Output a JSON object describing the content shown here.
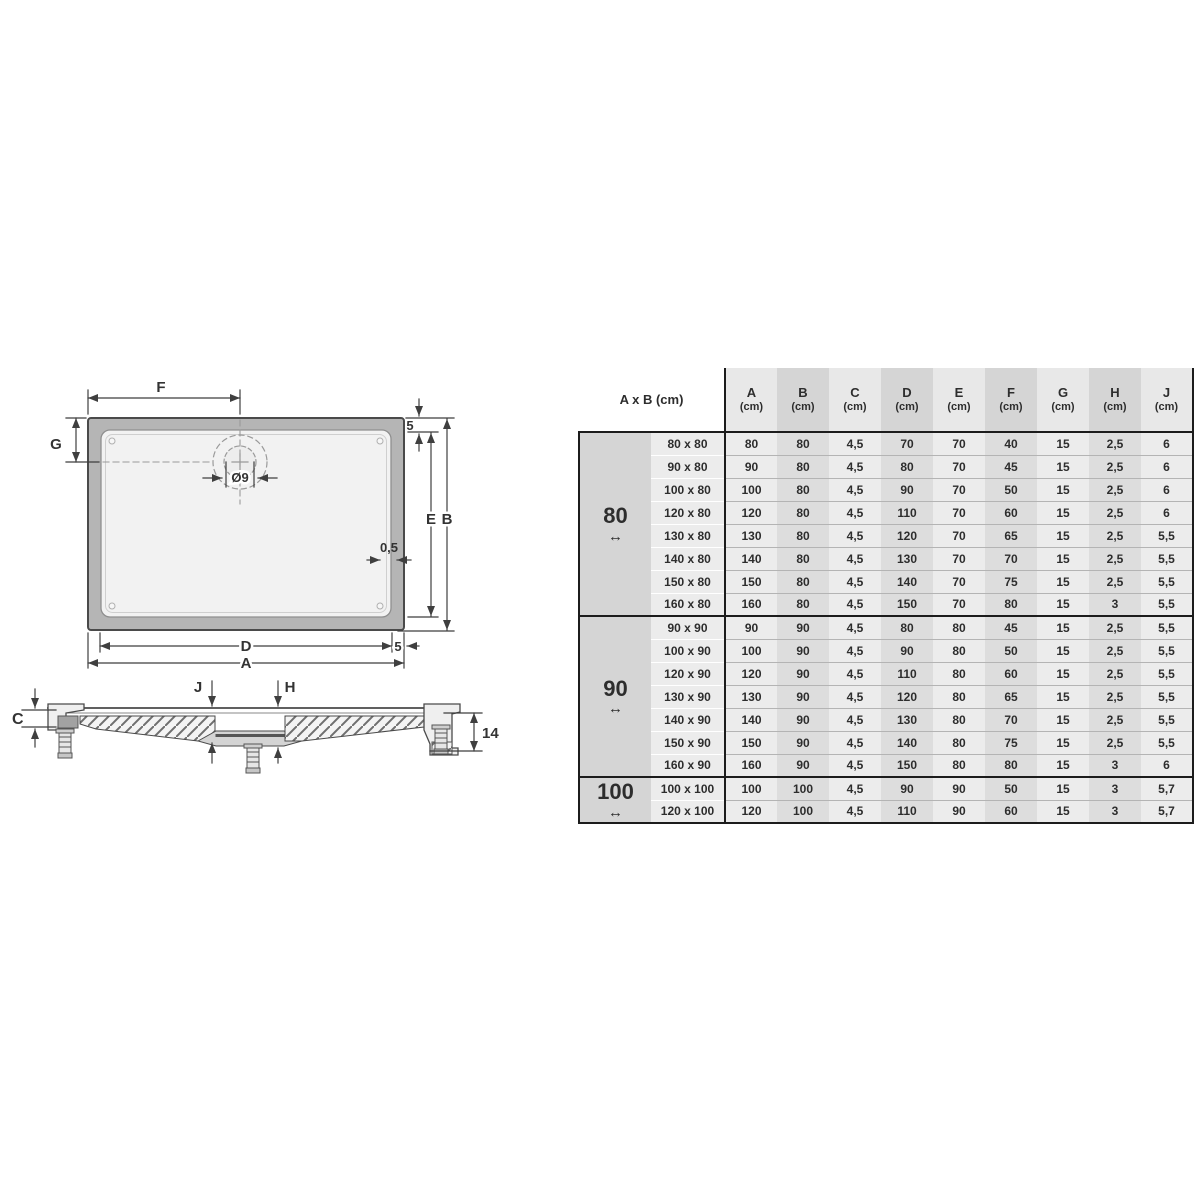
{
  "drawing": {
    "top_view": {
      "f_label": "F",
      "g_label": "G",
      "drain_label": "Ø9",
      "top_gap_label": "5",
      "e_label": "E",
      "b_label": "B",
      "half_label": "0,5",
      "d_label": "D",
      "bottom_gap_label": "5",
      "a_label": "A"
    },
    "side_view": {
      "c_label": "C",
      "j_label": "J",
      "h_label": "H",
      "height_label": "14"
    }
  },
  "table": {
    "corner_header": "A x B (cm)",
    "unit": "(cm)",
    "columns": [
      "A",
      "B",
      "C",
      "D",
      "E",
      "F",
      "G",
      "H",
      "J"
    ],
    "groups": [
      {
        "label": "80",
        "arrow": "↔",
        "rows": [
          {
            "size": "80 x 80",
            "values": [
              "80",
              "80",
              "4,5",
              "70",
              "70",
              "40",
              "15",
              "2,5",
              "6"
            ]
          },
          {
            "size": "90 x 80",
            "values": [
              "90",
              "80",
              "4,5",
              "80",
              "70",
              "45",
              "15",
              "2,5",
              "6"
            ]
          },
          {
            "size": "100 x 80",
            "values": [
              "100",
              "80",
              "4,5",
              "90",
              "70",
              "50",
              "15",
              "2,5",
              "6"
            ]
          },
          {
            "size": "120 x 80",
            "values": [
              "120",
              "80",
              "4,5",
              "110",
              "70",
              "60",
              "15",
              "2,5",
              "6"
            ]
          },
          {
            "size": "130 x 80",
            "values": [
              "130",
              "80",
              "4,5",
              "120",
              "70",
              "65",
              "15",
              "2,5",
              "5,5"
            ]
          },
          {
            "size": "140 x 80",
            "values": [
              "140",
              "80",
              "4,5",
              "130",
              "70",
              "70",
              "15",
              "2,5",
              "5,5"
            ]
          },
          {
            "size": "150 x 80",
            "values": [
              "150",
              "80",
              "4,5",
              "140",
              "70",
              "75",
              "15",
              "2,5",
              "5,5"
            ]
          },
          {
            "size": "160 x 80",
            "values": [
              "160",
              "80",
              "4,5",
              "150",
              "70",
              "80",
              "15",
              "3",
              "5,5"
            ]
          }
        ]
      },
      {
        "label": "90",
        "arrow": "↔",
        "rows": [
          {
            "size": "90 x 90",
            "values": [
              "90",
              "90",
              "4,5",
              "80",
              "80",
              "45",
              "15",
              "2,5",
              "5,5"
            ]
          },
          {
            "size": "100 x 90",
            "values": [
              "100",
              "90",
              "4,5",
              "90",
              "80",
              "50",
              "15",
              "2,5",
              "5,5"
            ]
          },
          {
            "size": "120 x 90",
            "values": [
              "120",
              "90",
              "4,5",
              "110",
              "80",
              "60",
              "15",
              "2,5",
              "5,5"
            ]
          },
          {
            "size": "130 x 90",
            "values": [
              "130",
              "90",
              "4,5",
              "120",
              "80",
              "65",
              "15",
              "2,5",
              "5,5"
            ]
          },
          {
            "size": "140 x 90",
            "values": [
              "140",
              "90",
              "4,5",
              "130",
              "80",
              "70",
              "15",
              "2,5",
              "5,5"
            ]
          },
          {
            "size": "150 x 90",
            "values": [
              "150",
              "90",
              "4,5",
              "140",
              "80",
              "75",
              "15",
              "2,5",
              "5,5"
            ]
          },
          {
            "size": "160 x 90",
            "values": [
              "160",
              "90",
              "4,5",
              "150",
              "80",
              "80",
              "15",
              "3",
              "6"
            ]
          }
        ]
      },
      {
        "label": "100",
        "arrow": "↔",
        "rows": [
          {
            "size": "100 x 100",
            "values": [
              "100",
              "100",
              "4,5",
              "90",
              "90",
              "50",
              "15",
              "3",
              "5,7"
            ]
          },
          {
            "size": "120 x 100",
            "values": [
              "120",
              "100",
              "4,5",
              "110",
              "90",
              "60",
              "15",
              "3",
              "5,7"
            ]
          }
        ]
      }
    ]
  },
  "colors": {
    "header_stripe_light": "#e8e8e8",
    "header_stripe_dark": "#d5d5d5",
    "body_stripe_light": "#ececec",
    "body_stripe_dark": "#dddddd",
    "table_border": "#1c1c1c",
    "tray_rim_gray": "#b5b5b5",
    "tray_inner_gray": "#f2f2f2"
  }
}
